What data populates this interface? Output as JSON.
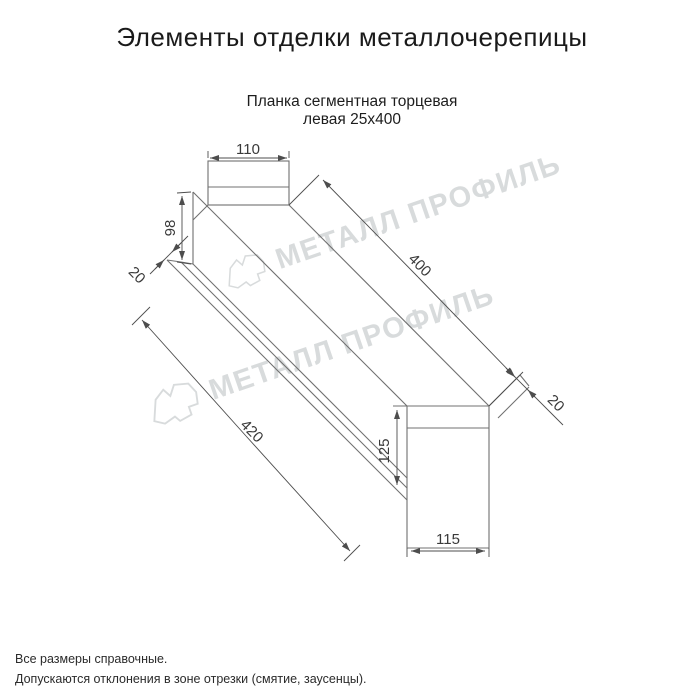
{
  "header": {
    "title": "Элементы отделки металлочерепицы",
    "subtitle_line1": "Планка сегментная торцевая",
    "subtitle_line2": "левая 25х400"
  },
  "watermark": {
    "text": "МЕТАЛЛ ПРОФИЛЬ",
    "color": "#d8dbdc"
  },
  "drawing": {
    "dimensions": {
      "top_flange_width": "110",
      "left_end_height": "98",
      "left_hem": "20",
      "top_length": "400",
      "bottom_length": "420",
      "right_hem": "20",
      "right_end_height": "125",
      "bottom_flange_width": "115"
    }
  },
  "footer": {
    "line1": "Все размеры справочные.",
    "line2": "Допускаются отклонения в зоне отрезки (смятие, заусенцы)."
  },
  "colors": {
    "profile_line": "#707070",
    "dimension_line": "#4d4d4d",
    "dimension_text": "#3a3a3a"
  }
}
